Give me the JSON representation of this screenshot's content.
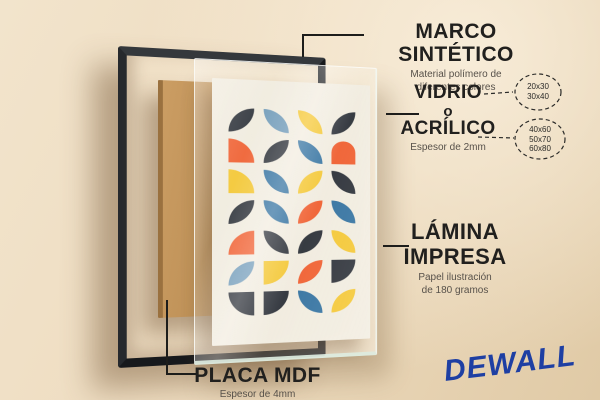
{
  "background": {
    "wall_top": "#f2e4cc",
    "wall_bottom": "#e0caa6"
  },
  "labels": {
    "marco": {
      "title": "MARCO SINTÉTICO",
      "subtitle_line1": "Material polímero de",
      "subtitle_line2": "diferentes colores"
    },
    "vidrio": {
      "line1": "VIDRIO",
      "line2": "o",
      "line3": "ACRÍLICO",
      "subtitle": "Espesor de 2mm"
    },
    "lamina": {
      "line1": "LÁMINA",
      "line2": "IMPRESA",
      "subtitle_line1": "Papel ilustración",
      "subtitle_line2": "de 180 gramos"
    },
    "placa": {
      "title": "PLACA MDF",
      "subtitle": "Espesor de 4mm"
    }
  },
  "badges": {
    "small_sizes": [
      "20x30",
      "30x40"
    ],
    "large_sizes": [
      "40x60",
      "50x70",
      "60x80"
    ]
  },
  "brand": {
    "name": "DEWALL",
    "color": "#1e3fa3"
  },
  "materials": {
    "frame_color": "#17191c",
    "mdf_color": "#bf9257",
    "text_color": "#21201e",
    "subtitle_color": "#57514a"
  },
  "artwork": {
    "background": "#f2ecdf",
    "palette": {
      "dark": "#272b33",
      "blue": "#2e6e9e",
      "blue_light": "#6e99b8",
      "yellow": "#f5c62e",
      "orange": "#f15b2b"
    },
    "grid": {
      "rows": 7,
      "cols": 4,
      "cells": [
        [
          "dark:a",
          "blue_light:b",
          "yellow:b",
          "dark:a"
        ],
        [
          "orange:qtr",
          "dark:a",
          "blue:b",
          "orange:dome"
        ],
        [
          "yellow:qtr",
          "blue:b",
          "yellow:a",
          "dark:b"
        ],
        [
          "dark:a",
          "blue:b",
          "orange:a",
          "blue:b"
        ],
        [
          "orange:qtl",
          "dark:b",
          "dark:a",
          "yellow:b"
        ],
        [
          "blue_light:a",
          "yellow:qbr",
          "orange:a",
          "dark:qbr"
        ],
        [
          "dark:qbl",
          "dark:qbr",
          "blue:b",
          "yellow:a"
        ]
      ]
    }
  }
}
